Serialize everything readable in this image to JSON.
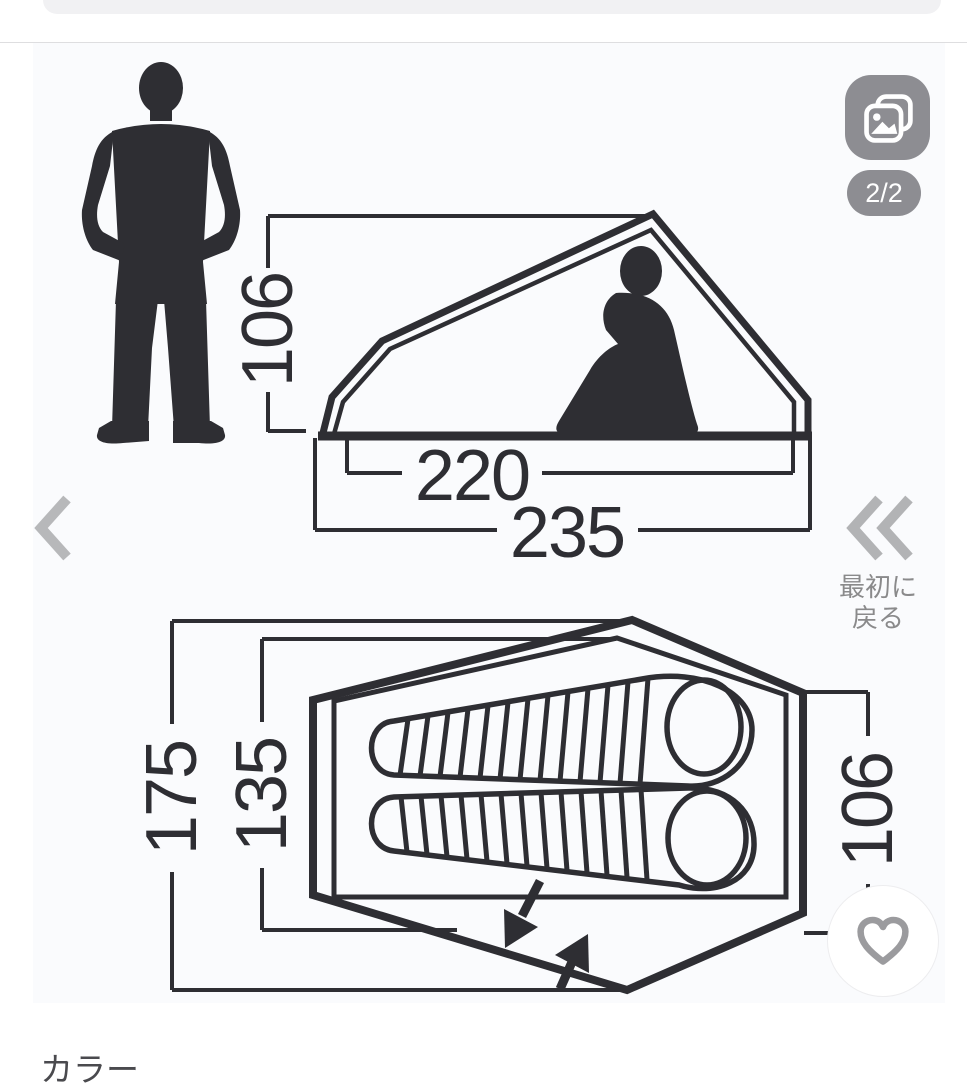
{
  "viewer": {
    "image_counter": "2/2",
    "back_to_first": [
      "最初に",
      "戻る"
    ]
  },
  "diagram": {
    "side_view": {
      "height": "106",
      "inner_length": "220",
      "outer_length": "235"
    },
    "top_view": {
      "outer_width": "175",
      "inner_width": "135",
      "vestibule_depth": "106"
    }
  },
  "page": {
    "color_section_heading": "カラー"
  },
  "colors": {
    "ink": "#2e2e33",
    "control_gray": "#8d8d92",
    "chevron_gray": "#b7b8ba",
    "label_gray": "#8a8a8b",
    "photo_background": "#fafbfd"
  },
  "icons": {
    "gallery": "photos-icon",
    "previous": "chevron-left-icon",
    "back_to_first": "double-chevron-left-icon",
    "favorite": "heart-icon"
  }
}
